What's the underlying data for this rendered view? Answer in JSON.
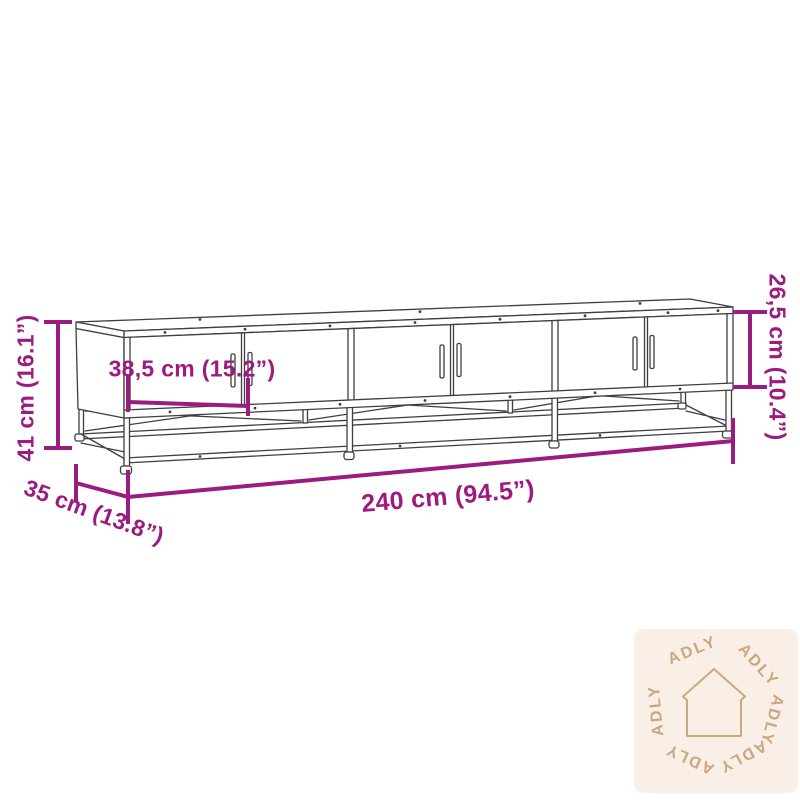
{
  "colors": {
    "background": "#ffffff",
    "accent": "#9B1B7E",
    "line": "#3F3F3F",
    "watermark_bg": "#F9EFE6",
    "watermark_fg": "#C3A077",
    "watermark_icon": "#C8A87E"
  },
  "diagram": {
    "dimensions": {
      "height": {
        "cm": "41",
        "inch": "16.1",
        "label": "41 cm (16.1”)"
      },
      "door_width": {
        "cm": "38,5",
        "inch": "15.2",
        "label": "38,5 cm (15.2”)"
      },
      "opening_height": {
        "cm": "26,5",
        "inch": "10.4",
        "label": "26,5 cm (10.4”)"
      },
      "width": {
        "cm": "240",
        "inch": "94.5",
        "label": "240 cm (94.5”)"
      },
      "depth": {
        "cm": "35",
        "inch": "13.8",
        "label": "35 cm (13.8”)"
      }
    }
  },
  "watermark": {
    "brand": "ADLY",
    "icon": "house-icon"
  }
}
